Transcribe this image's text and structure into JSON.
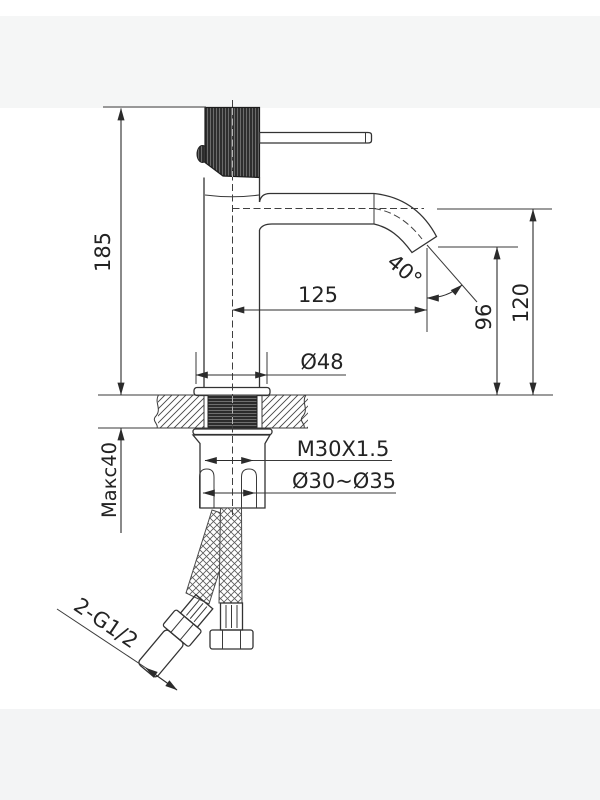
{
  "drawing": {
    "labels": {
      "total_height": "185",
      "spout_reach": "125",
      "spout_angle": "40°",
      "outlet_height": "96",
      "spout_height": "120",
      "body_diameter": "Ø48",
      "shank_thread": "M30X1.5",
      "mounting_hole": "Ø30~Ø35",
      "max_deck_thickness": "Макс40",
      "hose_connections": "2-G1/2"
    },
    "colors": {
      "line": "#333333",
      "dimension": "#2b2b2b",
      "background": "#ffffff",
      "handle_fill": "#2e2e2e"
    }
  }
}
